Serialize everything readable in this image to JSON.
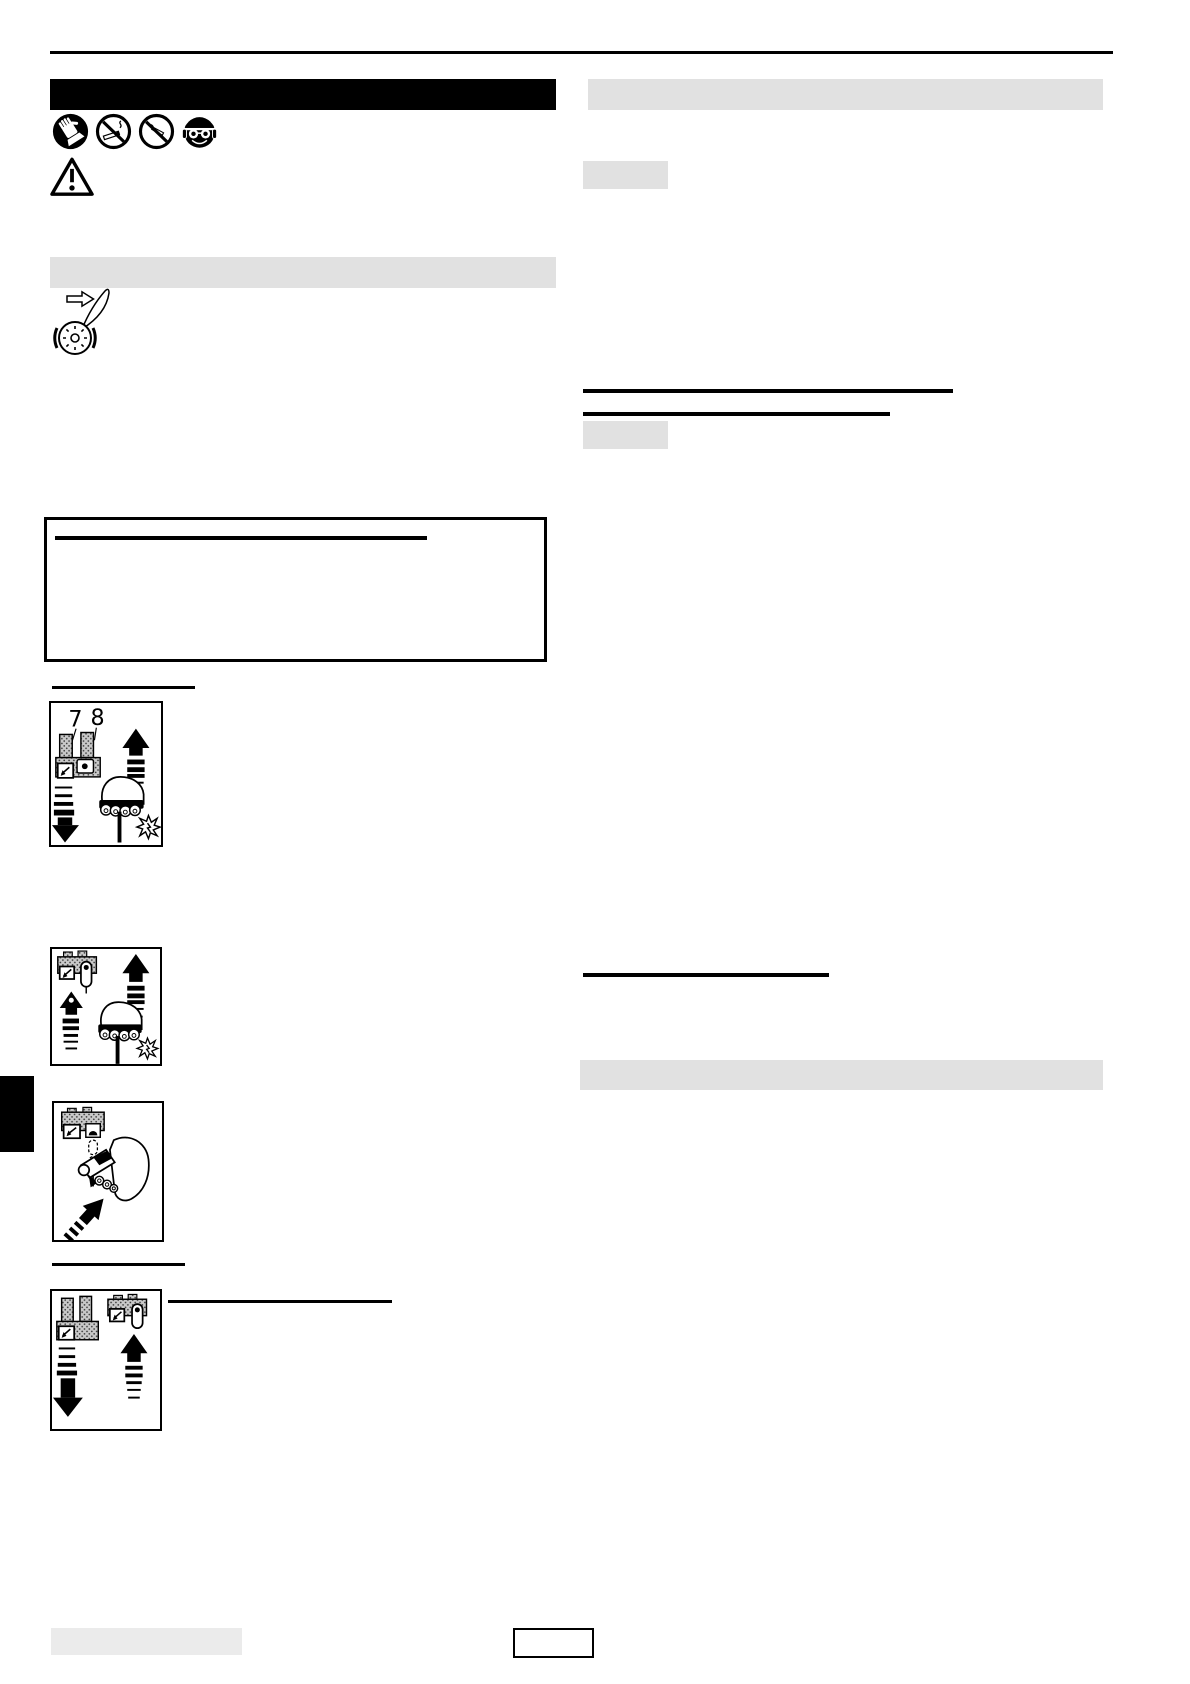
{
  "colors": {
    "ink": "#000000",
    "bar_gray": "#e1e1e1",
    "footer_gray": "#ebebeb"
  },
  "header": {
    "safety_icons": [
      {
        "name": "wear-protective-gloves-icon"
      },
      {
        "name": "no-smoking-icon"
      },
      {
        "name": "no-open-flame-icon"
      },
      {
        "name": "wear-head-eye-ear-protection-icon"
      }
    ],
    "warning_icon": "warning-triangle-icon"
  },
  "illustrations": {
    "left_column": "blade-sharpening-grinding-wheel",
    "figure_1": "pull-starter-grip-with-levers-7-8",
    "figure_2": "pull-starter-grip-lock-button",
    "figure_3": "push-primer-knob-hand-grip",
    "figure_4": "lever-positions-down-and-up"
  },
  "figures": {
    "levers_figure": {
      "callout_labels": [
        "7",
        "8"
      ]
    }
  }
}
